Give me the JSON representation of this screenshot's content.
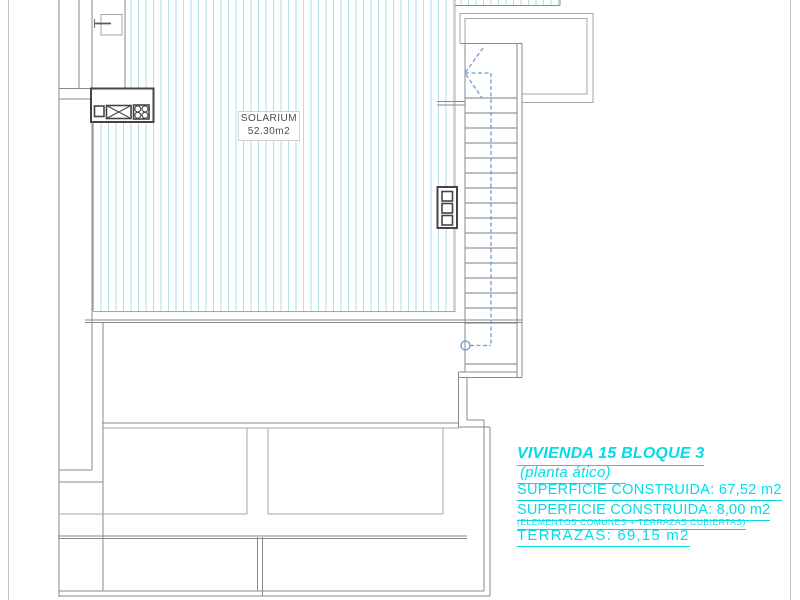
{
  "solarium": {
    "label": "SOLARIUM",
    "area": "52.30m2"
  },
  "annotation": {
    "title": "VIVIENDA 15 BLOQUE 3",
    "subtitle": "(planta ático)",
    "superficie_construida_1": "SUPERFICIE CONSTRUIDA: 67,52 m2",
    "superficie_construida_2": "SUPERFICIE CONSTRUIDA: 8,00 m2",
    "superficie_note": "(ELEMENTOS COMUNES + TERRAZAS CUBIERTAS)",
    "terrazas": "TERRAZAS: 69,15 m2"
  },
  "colors": {
    "annotation_cyan": "#00dcea",
    "hatch_cyan": "#b3dde8",
    "stair_path_blue": "#6b9bd2",
    "wall_gray": "#8a8a8a",
    "light_wall_gray": "#a6a6a6",
    "symbol_dark": "#454545",
    "label_text": "#4a4a4a"
  }
}
